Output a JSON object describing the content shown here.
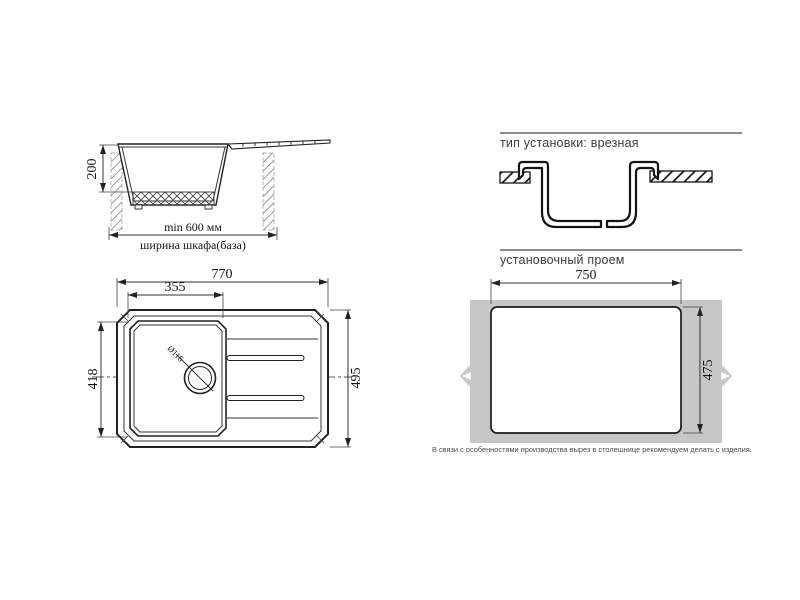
{
  "side_view": {
    "height_dim": "200",
    "min_width_dim": "min 600 мм",
    "cabinet_label": "ширина шкафа(база)"
  },
  "installation": {
    "title": "тип установки: врезная"
  },
  "top_view": {
    "overall_width_dim": "770",
    "bowl_width_dim": "355",
    "bowl_depth_dim": "418",
    "overall_depth_dim": "495",
    "drain_dim": "Ø116"
  },
  "cutout_section": {
    "title": "установочный проем",
    "width_dim": "750",
    "height_dim": "475",
    "note": "В связи с особенностями производства вырез в столешнице рекомендуем делать с изделия."
  },
  "colors": {
    "line": "#222222",
    "countertop_gray": "#c6c6c6",
    "rule_gray": "#8c8c8c"
  }
}
